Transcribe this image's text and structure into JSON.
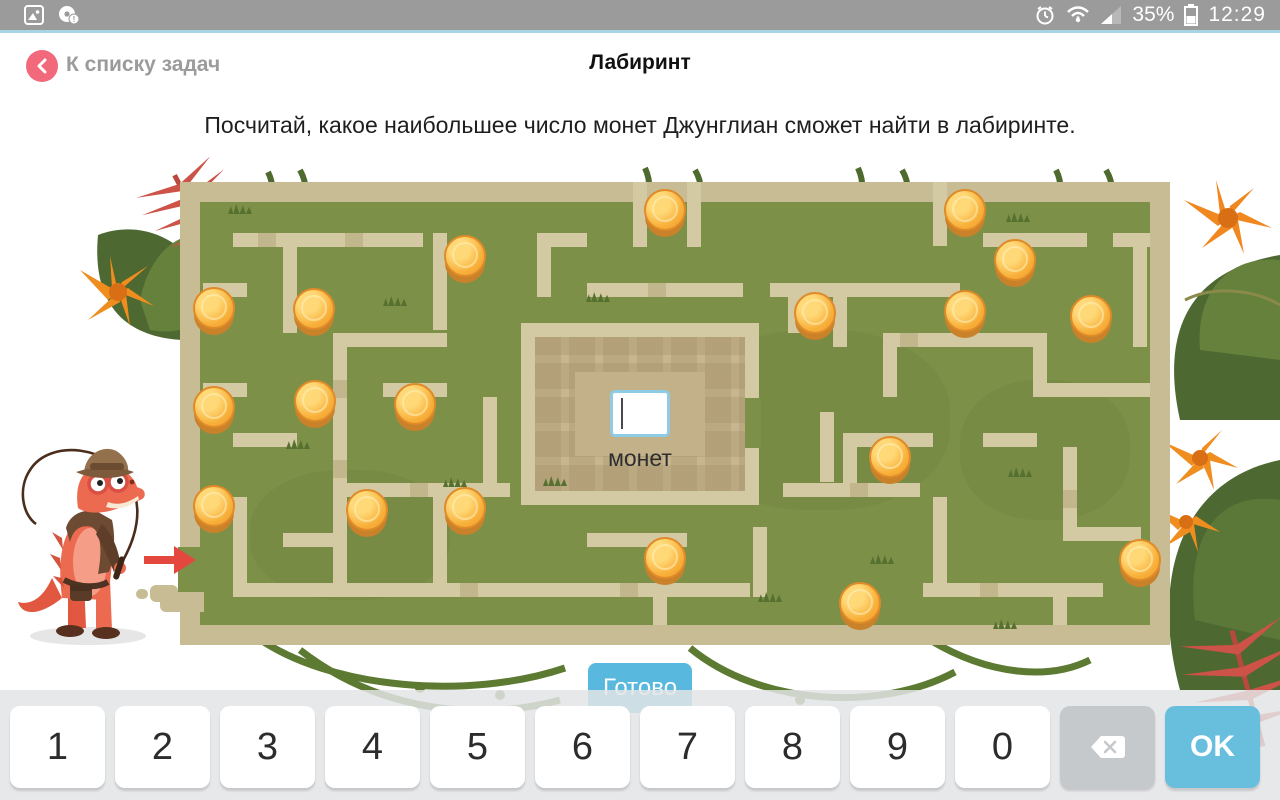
{
  "status_bar": {
    "battery_percent": "35%",
    "time": "12:29",
    "left_icons": [
      "gallery-icon",
      "disc-alert-icon"
    ],
    "right_icons": [
      "alarm-icon",
      "wifi-icon",
      "signal-icon",
      "battery-icon"
    ]
  },
  "header": {
    "back_label": "К списку задач",
    "title": "Лабиринт"
  },
  "task_text": "Посчитай, какое наибольшее число монет Джунглиан сможет найти в лабиринте.",
  "maze": {
    "input_value": "",
    "input_label": "монет",
    "coin_count": 19,
    "coins": [
      [
        663,
        212
      ],
      [
        963,
        212
      ],
      [
        463,
        258
      ],
      [
        1013,
        262
      ],
      [
        212,
        310
      ],
      [
        312,
        311
      ],
      [
        813,
        315
      ],
      [
        963,
        313
      ],
      [
        1089,
        318
      ],
      [
        212,
        409
      ],
      [
        313,
        403
      ],
      [
        413,
        406
      ],
      [
        888,
        459
      ],
      [
        212,
        508
      ],
      [
        365,
        512
      ],
      [
        463,
        510
      ],
      [
        663,
        560
      ],
      [
        1138,
        562
      ],
      [
        858,
        605
      ]
    ],
    "walls": [
      [
        233,
        233,
        190,
        14
      ],
      [
        537,
        233,
        50,
        14
      ],
      [
        983,
        233,
        104,
        14
      ],
      [
        1113,
        233,
        37,
        14
      ],
      [
        587,
        283,
        156,
        14
      ],
      [
        770,
        283,
        190,
        14
      ],
      [
        203,
        283,
        44,
        14
      ],
      [
        333,
        333,
        114,
        14
      ],
      [
        883,
        333,
        150,
        14
      ],
      [
        203,
        383,
        44,
        14
      ],
      [
        383,
        383,
        64,
        14
      ],
      [
        1047,
        383,
        103,
        14
      ],
      [
        233,
        433,
        64,
        14
      ],
      [
        857,
        433,
        76,
        14
      ],
      [
        983,
        433,
        54,
        14
      ],
      [
        333,
        483,
        177,
        14
      ],
      [
        783,
        483,
        137,
        14
      ],
      [
        587,
        533,
        100,
        14
      ],
      [
        283,
        533,
        64,
        14
      ],
      [
        1077,
        527,
        64,
        14
      ],
      [
        233,
        583,
        517,
        14
      ],
      [
        923,
        583,
        180,
        14
      ],
      [
        283,
        247,
        14,
        86
      ],
      [
        433,
        233,
        14,
        97
      ],
      [
        537,
        247,
        14,
        50
      ],
      [
        633,
        182,
        14,
        65
      ],
      [
        687,
        182,
        14,
        65
      ],
      [
        933,
        182,
        14,
        64
      ],
      [
        333,
        347,
        14,
        100
      ],
      [
        483,
        397,
        14,
        86
      ],
      [
        788,
        283,
        14,
        50
      ],
      [
        833,
        297,
        14,
        50
      ],
      [
        883,
        347,
        14,
        50
      ],
      [
        1033,
        333,
        14,
        64
      ],
      [
        1133,
        247,
        14,
        100
      ],
      [
        820,
        412,
        14,
        70
      ],
      [
        843,
        433,
        14,
        64
      ],
      [
        1063,
        447,
        14,
        94
      ],
      [
        233,
        497,
        14,
        86
      ],
      [
        333,
        433,
        14,
        150
      ],
      [
        433,
        497,
        14,
        86
      ],
      [
        933,
        497,
        14,
        86
      ],
      [
        753,
        527,
        14,
        70
      ],
      [
        653,
        597,
        14,
        28
      ],
      [
        1053,
        597,
        14,
        28
      ]
    ],
    "seams": [
      [
        258,
        233,
        18,
        14
      ],
      [
        345,
        233,
        18,
        14
      ],
      [
        648,
        283,
        18,
        14
      ],
      [
        900,
        333,
        18,
        14
      ],
      [
        333,
        380,
        14,
        18
      ],
      [
        410,
        483,
        18,
        14
      ],
      [
        850,
        483,
        18,
        14
      ],
      [
        460,
        583,
        18,
        14
      ],
      [
        620,
        583,
        18,
        14
      ],
      [
        980,
        583,
        18,
        14
      ],
      [
        333,
        460,
        14,
        18
      ],
      [
        1063,
        490,
        14,
        18
      ]
    ],
    "patches": [
      [
        690,
        330,
        260,
        180
      ],
      [
        250,
        470,
        200,
        130
      ],
      [
        960,
        380,
        170,
        140
      ]
    ],
    "tufts": [
      [
        228,
        203
      ],
      [
        383,
        295
      ],
      [
        586,
        291
      ],
      [
        443,
        476
      ],
      [
        543,
        475
      ],
      [
        758,
        591
      ],
      [
        1006,
        211
      ],
      [
        870,
        553
      ],
      [
        1008,
        466
      ],
      [
        286,
        438
      ],
      [
        993,
        618
      ]
    ],
    "colors": {
      "ground": "#7d9048",
      "wall": "#d3c9a2",
      "frame": "#c8bc94",
      "plaza": "#c7b690",
      "coin_gold": "#f8b03a",
      "arrow_red": "#e4473d"
    }
  },
  "done_button": {
    "label": "Готово"
  },
  "keyboard": {
    "digits": [
      "1",
      "2",
      "3",
      "4",
      "5",
      "6",
      "7",
      "8",
      "9",
      "0"
    ],
    "backspace_icon": "backspace-icon",
    "ok_label": "OK"
  }
}
